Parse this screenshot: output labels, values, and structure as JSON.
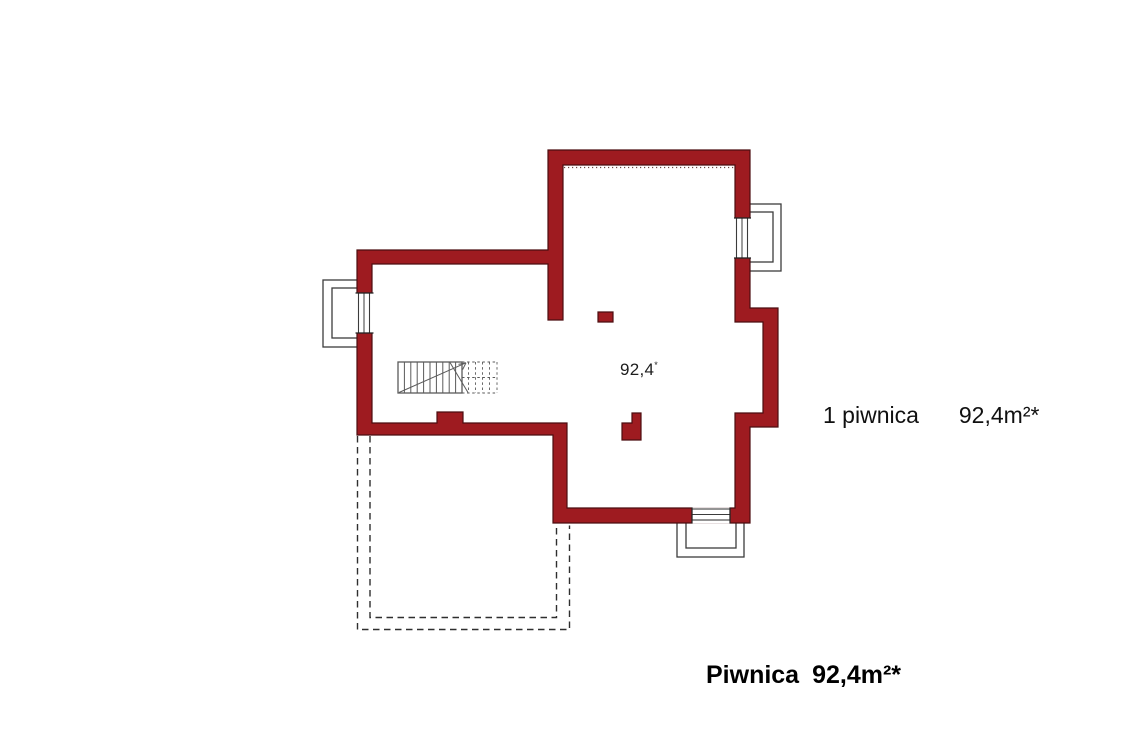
{
  "colors": {
    "wall_fill": "#9e1b20",
    "wall_stroke": "#4c0e10",
    "drawing_line": "#3c3c3c",
    "stair_line": "#5a5a5a",
    "text": "#101010"
  },
  "plan": {
    "area_label": "92,4",
    "area_label_mark": "*"
  },
  "legend": {
    "entry": "1 piwnica",
    "area": "92,4m²*"
  },
  "title": {
    "name": "Piwnica",
    "area": "92,4m²*"
  }
}
